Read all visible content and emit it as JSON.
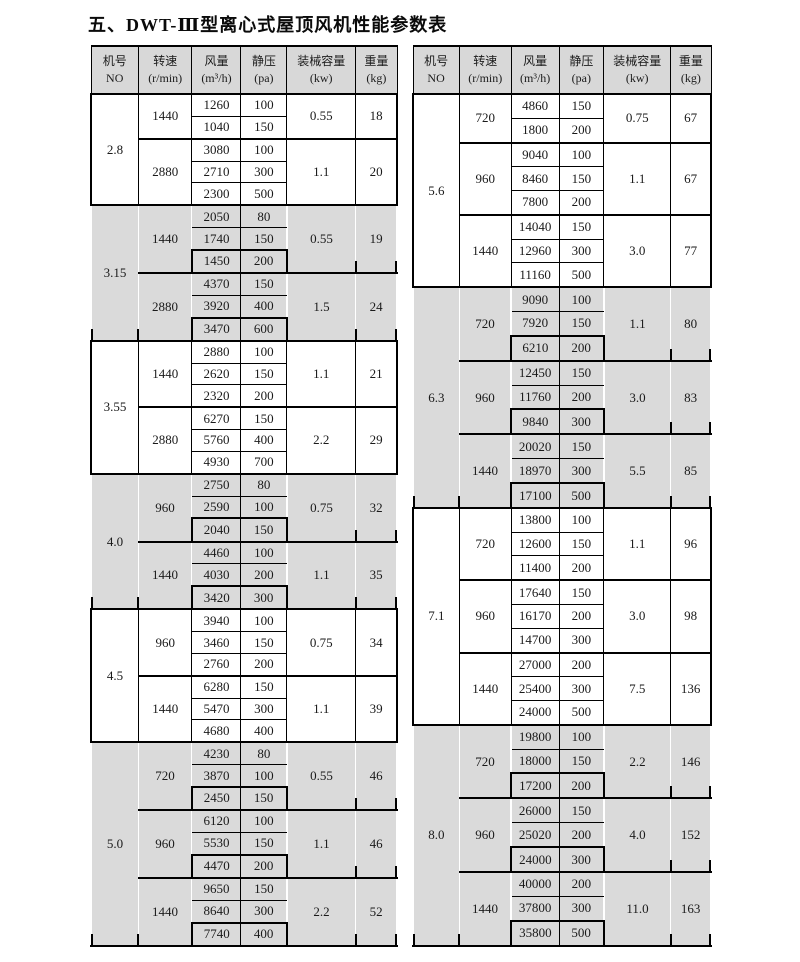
{
  "title": "五、DWT-Ⅲ型离心式屋顶风机性能参数表",
  "colors": {
    "page_bg": "#ffffff",
    "header_bg": "#d8d8d8",
    "shaded_bg": "#dadada",
    "border": "#000000"
  },
  "columns": [
    {
      "key": "no",
      "line1": "机号",
      "line2": "NO"
    },
    {
      "key": "speed",
      "line1": "转速",
      "line2": "(r/min)"
    },
    {
      "key": "airflow",
      "line1": "风量",
      "line2": "(m³/h)"
    },
    {
      "key": "pressure",
      "line1": "静压",
      "line2": "(pa)"
    },
    {
      "key": "power",
      "line1": "装械容量",
      "line2": "(kw)"
    },
    {
      "key": "weight",
      "line1": "重量",
      "line2": "(kg)"
    }
  ],
  "tables": [
    {
      "id": "left",
      "sections": [
        {
          "no": "2.8",
          "shaded": false,
          "groups": [
            {
              "speed": "1440",
              "rows": [
                [
                  1260,
                  100
                ],
                [
                  1040,
                  150
                ]
              ],
              "power": "0.55",
              "weight": "18"
            },
            {
              "speed": "2880",
              "rows": [
                [
                  3080,
                  100
                ],
                [
                  2710,
                  300
                ],
                [
                  2300,
                  500
                ]
              ],
              "power": "1.1",
              "weight": "20"
            }
          ]
        },
        {
          "no": "3.15",
          "shaded": true,
          "groups": [
            {
              "speed": "1440",
              "rows": [
                [
                  2050,
                  80
                ],
                [
                  1740,
                  150
                ],
                [
                  1450,
                  200
                ]
              ],
              "power": "0.55",
              "weight": "19"
            },
            {
              "speed": "2880",
              "rows": [
                [
                  4370,
                  150
                ],
                [
                  3920,
                  400
                ],
                [
                  3470,
                  600
                ]
              ],
              "power": "1.5",
              "weight": "24"
            }
          ]
        },
        {
          "no": "3.55",
          "shaded": false,
          "groups": [
            {
              "speed": "1440",
              "rows": [
                [
                  2880,
                  100
                ],
                [
                  2620,
                  150
                ],
                [
                  2320,
                  200
                ]
              ],
              "power": "1.1",
              "weight": "21"
            },
            {
              "speed": "2880",
              "rows": [
                [
                  6270,
                  150
                ],
                [
                  5760,
                  400
                ],
                [
                  4930,
                  700
                ]
              ],
              "power": "2.2",
              "weight": "29"
            }
          ]
        },
        {
          "no": "4.0",
          "shaded": true,
          "groups": [
            {
              "speed": "960",
              "rows": [
                [
                  2750,
                  80
                ],
                [
                  2590,
                  100
                ],
                [
                  2040,
                  150
                ]
              ],
              "power": "0.75",
              "weight": "32"
            },
            {
              "speed": "1440",
              "rows": [
                [
                  4460,
                  100
                ],
                [
                  4030,
                  200
                ],
                [
                  3420,
                  300
                ]
              ],
              "power": "1.1",
              "weight": "35"
            }
          ]
        },
        {
          "no": "4.5",
          "shaded": false,
          "groups": [
            {
              "speed": "960",
              "rows": [
                [
                  3940,
                  100
                ],
                [
                  3460,
                  150
                ],
                [
                  2760,
                  200
                ]
              ],
              "power": "0.75",
              "weight": "34"
            },
            {
              "speed": "1440",
              "rows": [
                [
                  6280,
                  150
                ],
                [
                  5470,
                  300
                ],
                [
                  4680,
                  400
                ]
              ],
              "power": "1.1",
              "weight": "39"
            }
          ]
        },
        {
          "no": "5.0",
          "shaded": true,
          "groups": [
            {
              "speed": "720",
              "rows": [
                [
                  4230,
                  80
                ],
                [
                  3870,
                  100
                ],
                [
                  2450,
                  150
                ]
              ],
              "power": "0.55",
              "weight": "46"
            },
            {
              "speed": "960",
              "rows": [
                [
                  6120,
                  100
                ],
                [
                  5530,
                  150
                ],
                [
                  4470,
                  200
                ]
              ],
              "power": "1.1",
              "weight": "46"
            },
            {
              "speed": "1440",
              "rows": [
                [
                  9650,
                  150
                ],
                [
                  8640,
                  300
                ],
                [
                  7740,
                  400
                ]
              ],
              "power": "2.2",
              "weight": "52"
            }
          ]
        }
      ]
    },
    {
      "id": "right",
      "sections": [
        {
          "no": "5.6",
          "shaded": false,
          "groups": [
            {
              "speed": "720",
              "rows": [
                [
                  4860,
                  150
                ],
                [
                  1800,
                  200
                ]
              ],
              "power": "0.75",
              "weight": "67"
            },
            {
              "speed": "960",
              "rows": [
                [
                  9040,
                  100
                ],
                [
                  8460,
                  150
                ],
                [
                  7800,
                  200
                ]
              ],
              "power": "1.1",
              "weight": "67"
            },
            {
              "speed": "1440",
              "rows": [
                [
                  14040,
                  150
                ],
                [
                  12960,
                  300
                ],
                [
                  11160,
                  500
                ]
              ],
              "power": "3.0",
              "weight": "77"
            }
          ]
        },
        {
          "no": "6.3",
          "shaded": true,
          "groups": [
            {
              "speed": "720",
              "rows": [
                [
                  9090,
                  100
                ],
                [
                  7920,
                  150
                ],
                [
                  6210,
                  200
                ]
              ],
              "power": "1.1",
              "weight": "80"
            },
            {
              "speed": "960",
              "rows": [
                [
                  12450,
                  150
                ],
                [
                  11760,
                  200
                ],
                [
                  9840,
                  300
                ]
              ],
              "power": "3.0",
              "weight": "83"
            },
            {
              "speed": "1440",
              "rows": [
                [
                  20020,
                  150
                ],
                [
                  18970,
                  300
                ],
                [
                  17100,
                  500
                ]
              ],
              "power": "5.5",
              "weight": "85"
            }
          ]
        },
        {
          "no": "7.1",
          "shaded": false,
          "groups": [
            {
              "speed": "720",
              "rows": [
                [
                  13800,
                  100
                ],
                [
                  12600,
                  150
                ],
                [
                  11400,
                  200
                ]
              ],
              "power": "1.1",
              "weight": "96"
            },
            {
              "speed": "960",
              "rows": [
                [
                  17640,
                  150
                ],
                [
                  16170,
                  200
                ],
                [
                  14700,
                  300
                ]
              ],
              "power": "3.0",
              "weight": "98"
            },
            {
              "speed": "1440",
              "rows": [
                [
                  27000,
                  200
                ],
                [
                  25400,
                  300
                ],
                [
                  24000,
                  500
                ]
              ],
              "power": "7.5",
              "weight": "136"
            }
          ]
        },
        {
          "no": "8.0",
          "shaded": true,
          "groups": [
            {
              "speed": "720",
              "rows": [
                [
                  19800,
                  100
                ],
                [
                  18000,
                  150
                ],
                [
                  17200,
                  200
                ]
              ],
              "power": "2.2",
              "weight": "146"
            },
            {
              "speed": "960",
              "rows": [
                [
                  26000,
                  150
                ],
                [
                  25020,
                  200
                ],
                [
                  24000,
                  300
                ]
              ],
              "power": "4.0",
              "weight": "152"
            },
            {
              "speed": "1440",
              "rows": [
                [
                  40000,
                  200
                ],
                [
                  37800,
                  300
                ],
                [
                  35800,
                  500
                ]
              ],
              "power": "11.0",
              "weight": "163"
            }
          ]
        }
      ]
    }
  ]
}
